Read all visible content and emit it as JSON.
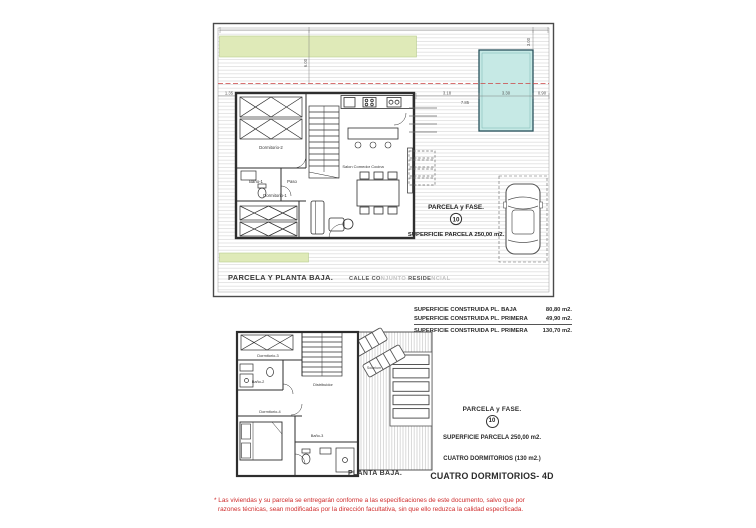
{
  "page": {
    "watermark": "EUROPE HOMES"
  },
  "plan_top": {
    "caption": "PARCELA Y PLANTA BAJA.",
    "street": {
      "s1": "CALLE CO",
      "s2": "NJUNTO ",
      "s3": "RESIDE",
      "s4": "NCIAL"
    },
    "parcel_label": "PARCELA y FASE.",
    "parcel_number": "10",
    "parcel_area": "SUPERFICIE PARCELA 250,00 m2.",
    "rooms": {
      "dorm2": "Dormitorio-2",
      "bano1": "Baño-1",
      "paso": "Paso",
      "dorm1": "Dormitorio-1",
      "salon": "Salon Comedor Cocina"
    },
    "dims": {
      "left": "1.35",
      "a": "3.18",
      "pool": "3.30",
      "b": "0.90",
      "total": "7.85",
      "v1": "6.00",
      "v2": "3.00"
    }
  },
  "plan_lower": {
    "caption": "PLANTA BAJA.",
    "rooms": {
      "dorm3": "Dormitorio-3",
      "bano2": "Baño-2",
      "dist": "Distribuidor",
      "dorm4": "Dormitorio-4",
      "bano3": "Baño-3",
      "solarium": "Solarium"
    }
  },
  "areas_table": {
    "rows": [
      {
        "label": "SUPERFICIE CONSTRUIDA PL. BAJA",
        "value": "80,80 m2."
      },
      {
        "label": "SUPERFICIE CONSTRUIDA PL. PRIMERA",
        "value": "49,90 m2."
      },
      {
        "label": "SUPERFICIE CONSTRUIDA PL. PRIMERA",
        "value": "130,70 m2."
      }
    ]
  },
  "info_block": {
    "parcel_label": "PARCELA y FASE.",
    "parcel_number": "10",
    "parcel_area": "SUPERFICIE PARCELA 250,00 m2.",
    "bedrooms": "CUATRO DORMITORIOS (130 m2.)",
    "type": "CUATRO DORMITORIOS- 4D"
  },
  "disclaimer": {
    "line1": "* Las viviendas y su parcela se entregarán conforme a las especificaciones de este documento, salvo que por",
    "line2": "razones técnicas, sean modificadas por la dirección facultativa, sin que ello reduzca la calidad especificada."
  },
  "colors": {
    "garden_green": "#dfeab8",
    "pool_blue": "#c6e9e5",
    "setback_red": "#cc4444",
    "disclaimer_red": "#cf2b2b",
    "line_dark": "#3a3a3a"
  }
}
